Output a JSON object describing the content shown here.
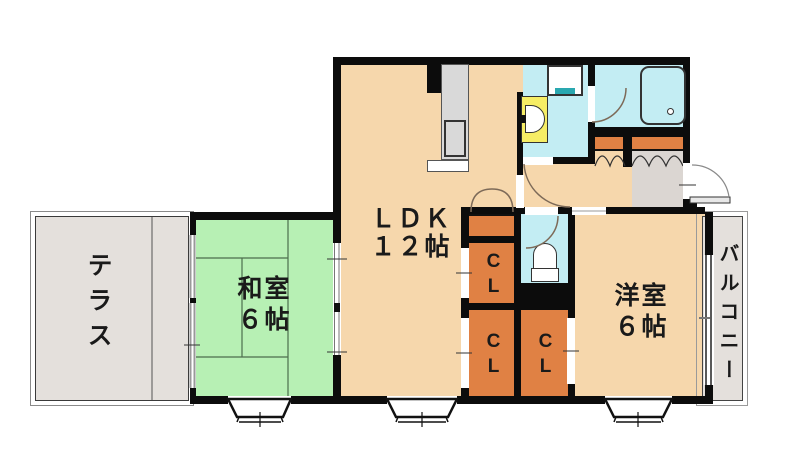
{
  "plan_title": "apartment-floor-plan",
  "rooms": {
    "ldk": {
      "label_line1": "ＬＤＫ",
      "label_line2": "１２帖"
    },
    "washitsu": {
      "label_line1": "和室",
      "label_line2": "６帖"
    },
    "yoshitsu": {
      "label_line1": "洋室",
      "label_line2": "６帖"
    },
    "terrace": {
      "label": "テラス"
    },
    "balcony": {
      "label": "バルコニー"
    },
    "closet_top": {
      "label": "CL"
    },
    "closet_bottom_left": {
      "label": "CL"
    },
    "closet_bottom_right": {
      "label": "CL"
    }
  },
  "colors": {
    "wall": "#0c0c0c",
    "room_peach": "#f6d7ac",
    "tatami_green": "#b7f0b4",
    "terrace_gray": "#e4e0dc",
    "genkan_gray": "#dbd6d2",
    "closet_orange": "#e08144",
    "water_cyan": "#c3edf3",
    "vanity_yellow": "#f6ed65",
    "washer_teal": "#2aa8b0",
    "counter_gray": "#d9d9d9"
  }
}
